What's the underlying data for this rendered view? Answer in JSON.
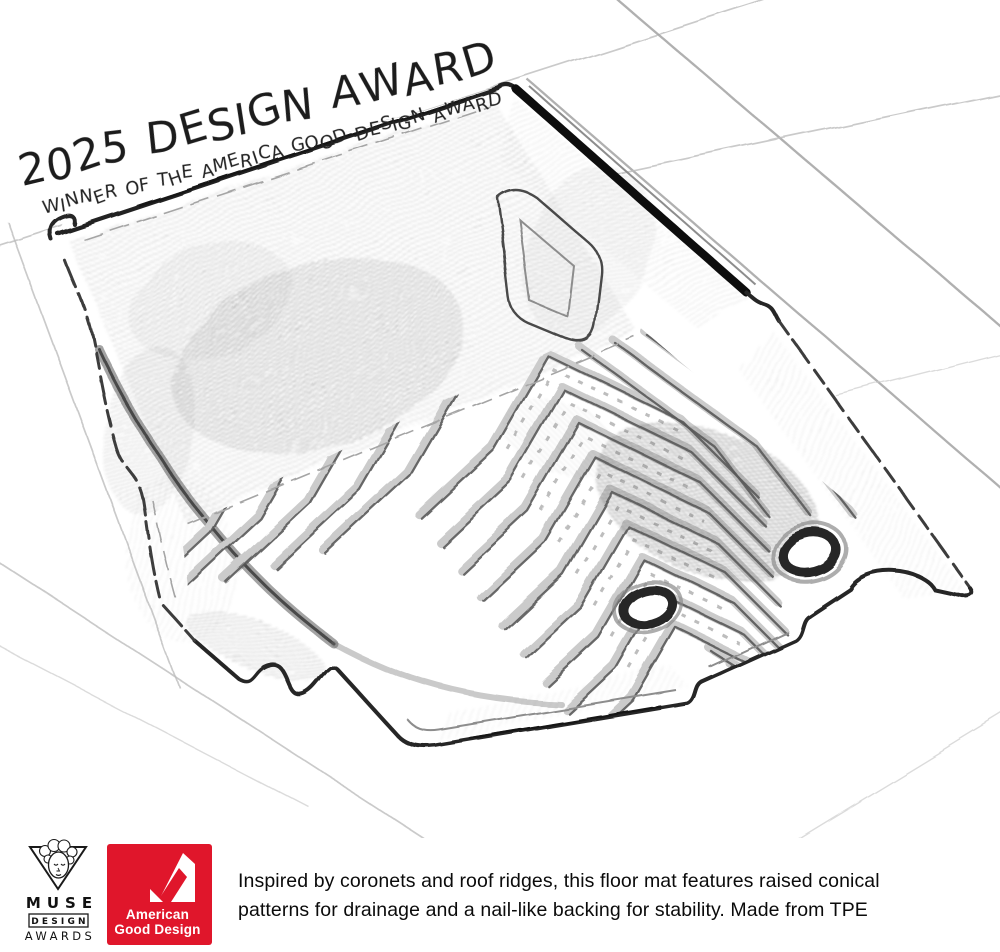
{
  "award_banner": {
    "title": "2025 DESIGN AWARD",
    "subtitle": "WINNER OF THE AMERICA GOOD DESIGN AWARD"
  },
  "footer": {
    "muse": {
      "line1": "MUSE",
      "line2": "DESIGN",
      "line3": "AWARDS"
    },
    "american_good_design": {
      "line1": "American",
      "line2": "Good Design",
      "brand_color": "#e0162b"
    },
    "description": "Inspired by coronets and roof ridges, this floor mat features raised conical patterns for drainage and a nail-like backing for stability. Made from TPE"
  }
}
